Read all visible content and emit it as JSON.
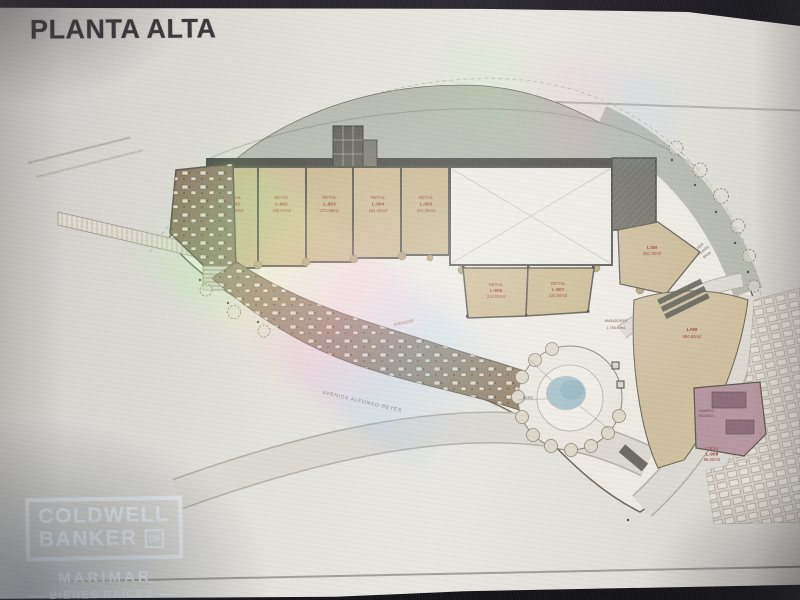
{
  "header": {
    "title": "PLANTA ALTA"
  },
  "watermark": {
    "brand_top": "COLDWELL",
    "brand_bottom": "BANKER",
    "logo_monogram": "CB",
    "agency": "MARIMAR",
    "tagline": "BIENES RAÍCES"
  },
  "plan": {
    "shop_units": [
      {
        "type": "RETAIL",
        "id": "L-901",
        "area": "104.09m2"
      },
      {
        "type": "RETAIL",
        "id": "L-902",
        "area": "188.97m2"
      },
      {
        "type": "RETAIL",
        "id": "L-903",
        "area": "271.99m2"
      },
      {
        "type": "RETAIL",
        "id": "L-904",
        "area": "241.63m2"
      },
      {
        "type": "RETAIL",
        "id": "L-905",
        "area": "224.28m2"
      }
    ],
    "lower_units": [
      {
        "type": "RETAIL",
        "id": "L-906",
        "area": "218.00m2"
      },
      {
        "type": "RETAIL",
        "id": "L-907",
        "area": "220.56m2"
      }
    ],
    "right_units": [
      {
        "id": "LXM",
        "area": "330.78m2"
      },
      {
        "id": "LAW",
        "area": "450.60m2"
      },
      {
        "type": "LOCAL",
        "id": "L-908",
        "area": "98.00m2"
      }
    ],
    "labels": {
      "see_ground_1": "VER",
      "see_ground_2": "PLANTA",
      "see_ground_3": "BAJA",
      "walkways_1": "ANDADORES",
      "walkways_2": "1,748.40m2",
      "patio": "PATIO",
      "avenue": "AVENIDA ALFONSO REYES",
      "boardwalk": "ANDADOR",
      "technical_1": "CUARTO",
      "technical_2": "TECNICO"
    }
  }
}
